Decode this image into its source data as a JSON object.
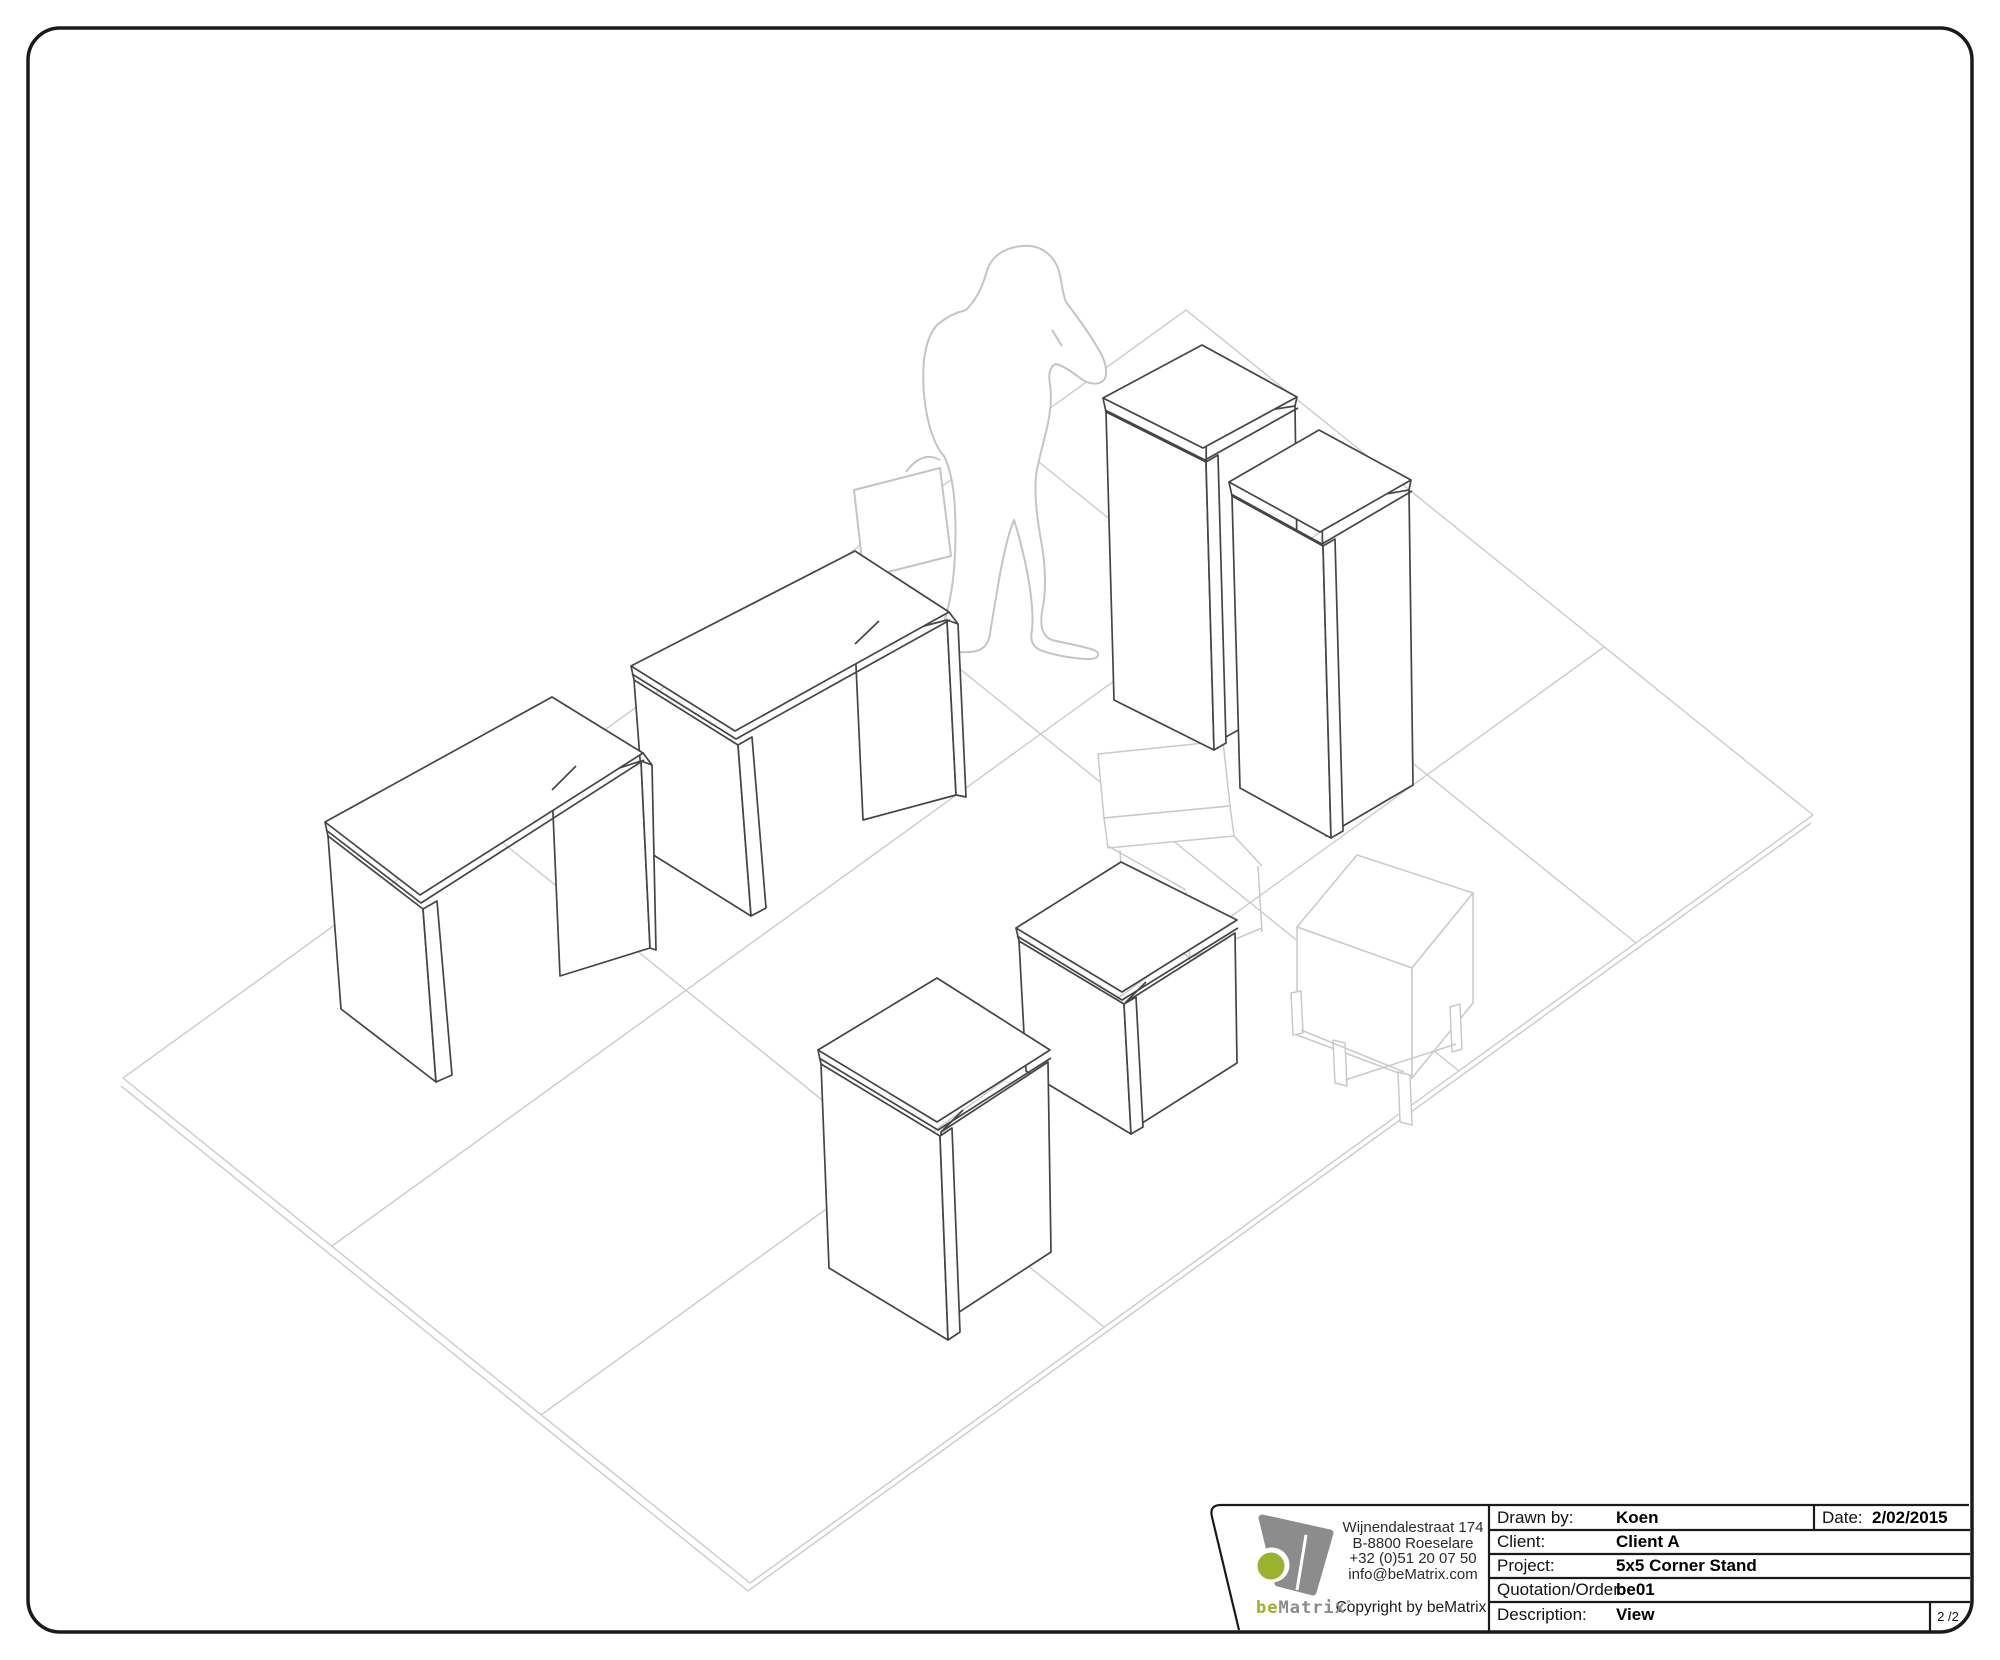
{
  "document": {
    "type": "beMatrix technical drawing sheet",
    "page_indicator": "2 /2"
  },
  "colors": {
    "accent_green": "#9ab22e",
    "logo_gray": "#8c8c8c",
    "furniture_line": "#454545",
    "faint_line": "#c8c8c8",
    "border_ink": "#1a1a1a"
  },
  "logo": {
    "brand_prefix": "be",
    "brand_suffix": "Matrix",
    "registered_mark": "°",
    "address_lines": [
      "Wijnendalestraat 174",
      "B-8800 Roeselare",
      "+32 (0)51 20 07 50",
      "info@beMatrix.com"
    ],
    "copyright": "Copyright by beMatrix"
  },
  "title_block": {
    "fields": [
      {
        "label": "Drawn by:",
        "value": "Koen"
      },
      {
        "label": "Client:",
        "value": "Client A"
      },
      {
        "label": "Project:",
        "value": "5x5 Corner Stand"
      },
      {
        "label": "Quotation/Order:",
        "value": "be01"
      },
      {
        "label": "Description:",
        "value": "View"
      }
    ],
    "date_label": "Date:",
    "date_value": "2/02/2015",
    "page_indicator": "2 /2"
  }
}
